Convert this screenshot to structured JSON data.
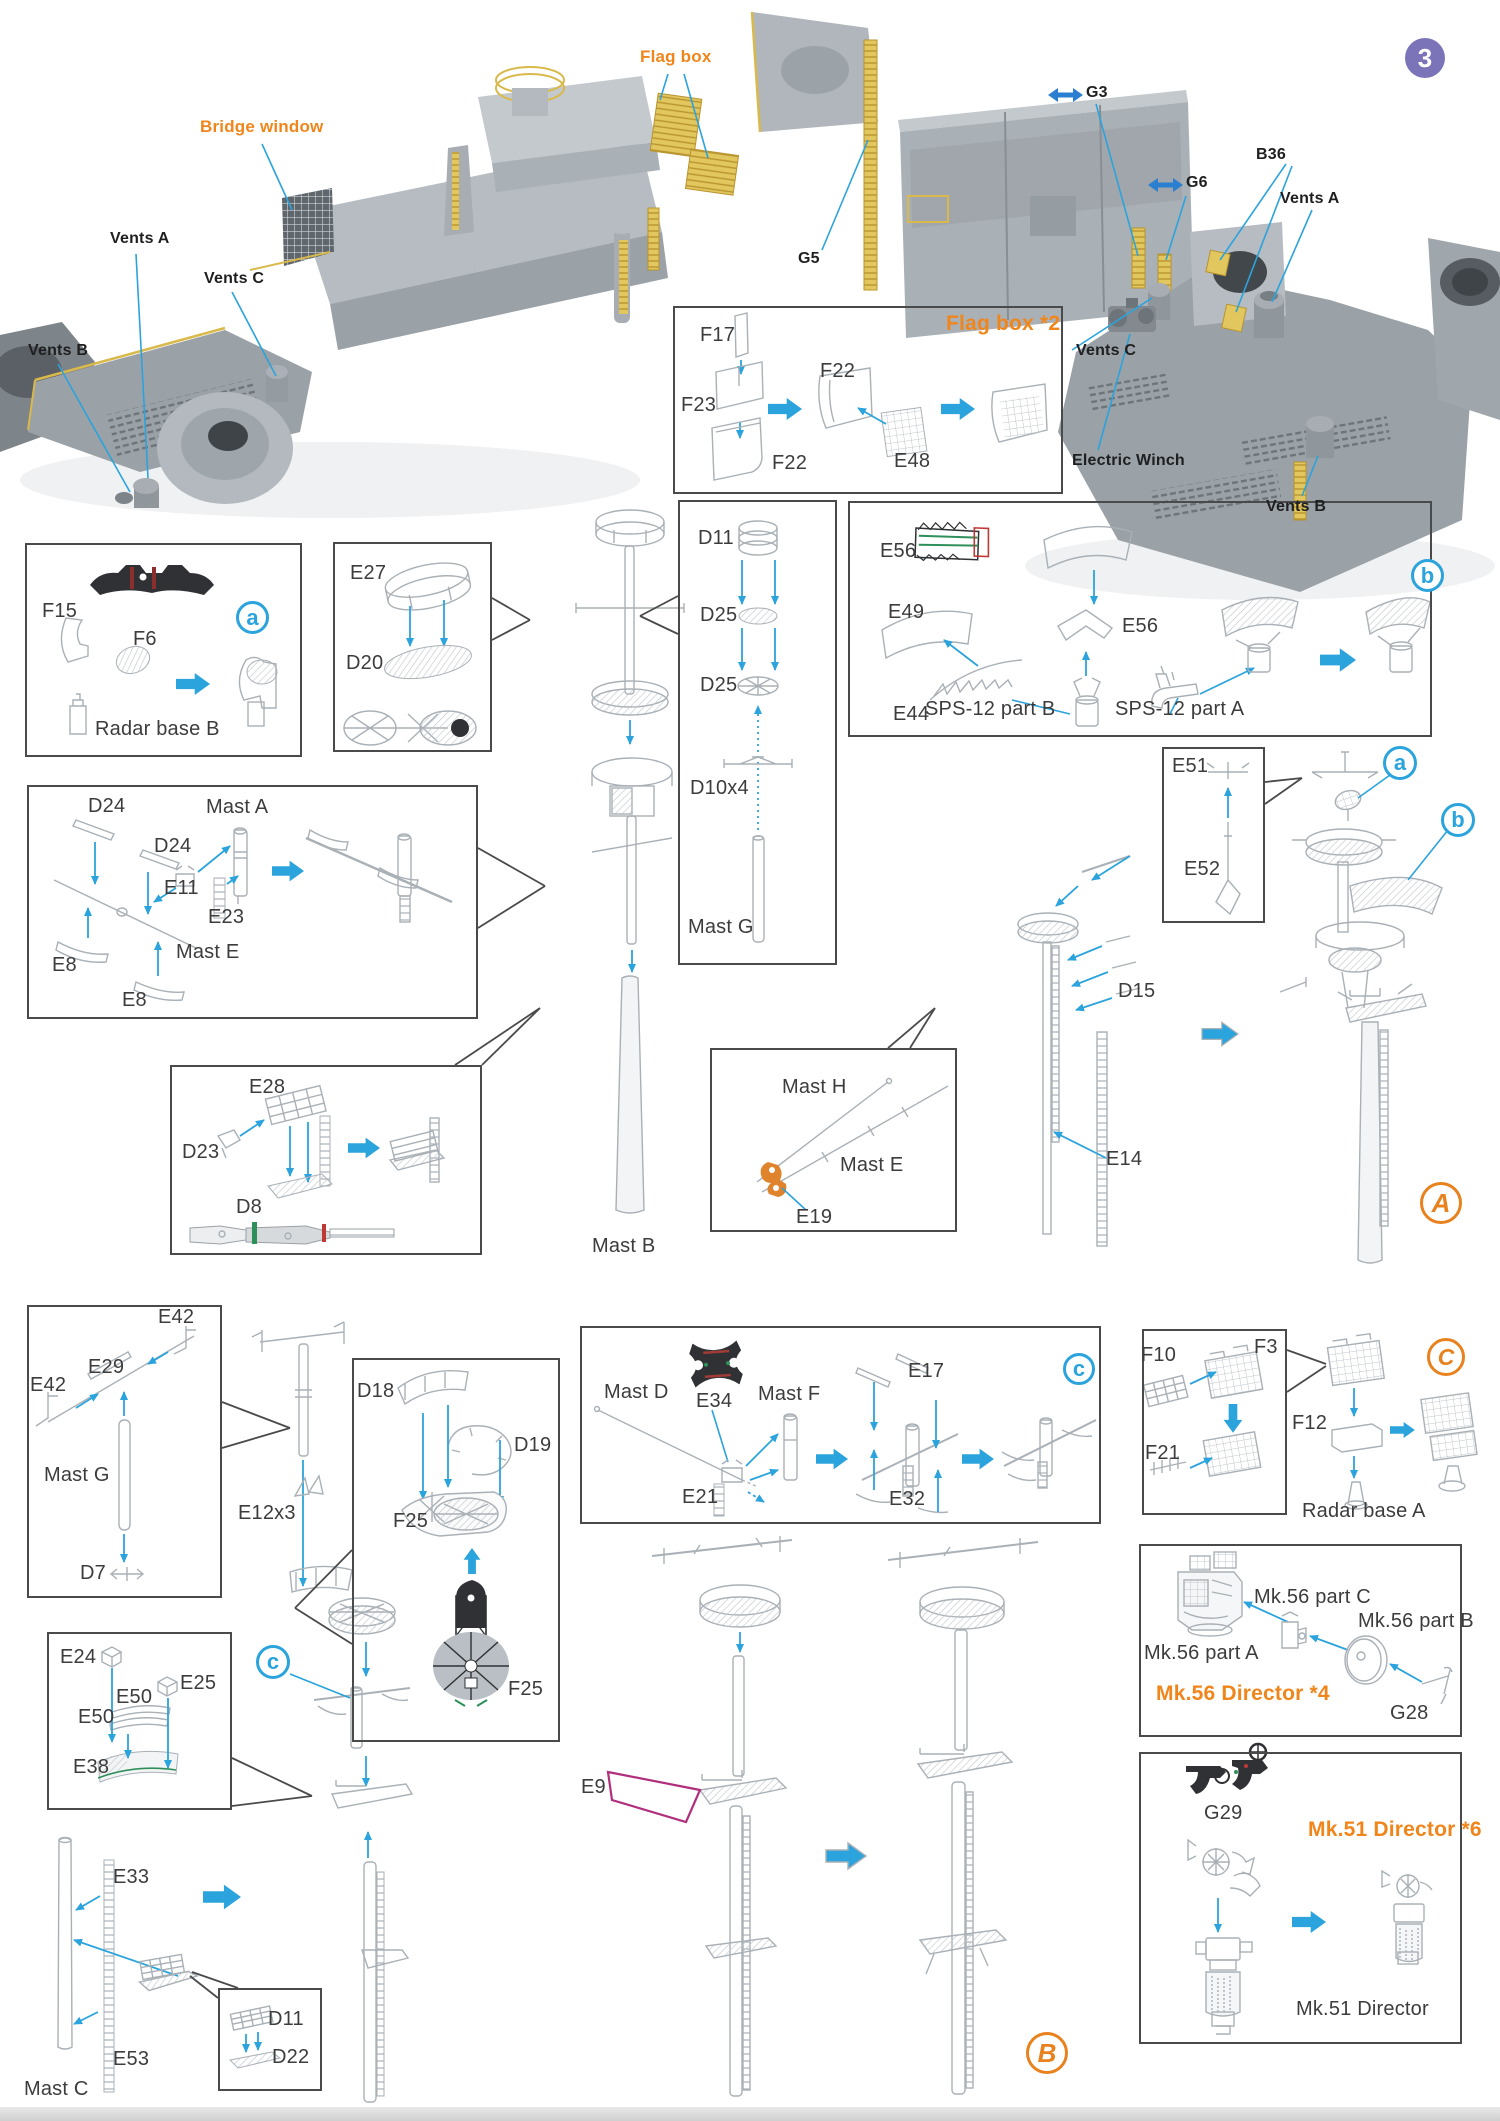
{
  "t": {
    "badge3": "3",
    "bridge_window": "Bridge window",
    "flag_box": "Flag box",
    "vents_a": "Vents A",
    "vents_b": "Vents B",
    "vents_c": "Vents C",
    "g5": "G5",
    "g3": "G3",
    "g6": "G6",
    "b36": "B36",
    "electric_winch": "Electric Winch",
    "flagbox2_title": "Flag box *2",
    "f17": "F17",
    "f23": "F23",
    "f22": "F22",
    "e48": "E48",
    "f15": "F15",
    "f6": "F6",
    "radar_base_b": "Radar base B",
    "e27": "E27",
    "d20": "D20",
    "d11": "D11",
    "d25": "D25",
    "d10x4": "D10x4",
    "mast_g": "Mast G",
    "e56": "E56",
    "e49": "E49",
    "e44": "E44",
    "sps12_b": "SPS-12 part B",
    "sps12_a": "SPS-12 part A",
    "d24": "D24",
    "mast_a": "Mast A",
    "e11": "E11",
    "e23": "E23",
    "e8": "E8",
    "mast_e": "Mast E",
    "e28": "E28",
    "d23": "D23",
    "d8": "D8",
    "mast_b": "Mast B",
    "mast_h": "Mast H",
    "e19": "E19",
    "e51": "E51",
    "e52": "E52",
    "d15": "D15",
    "e14": "E14",
    "e42": "E42",
    "e29": "E29",
    "d7": "D7",
    "e12x3": "E12x3",
    "d18": "D18",
    "d19": "D19",
    "f25": "F25",
    "mast_d": "Mast D",
    "e34": "E34",
    "mast_f": "Mast F",
    "e21": "E21",
    "e17": "E17",
    "e32": "E32",
    "f10": "F10",
    "f3": "F3",
    "f21": "F21",
    "f12": "F12",
    "radar_base_a": "Radar base A",
    "mk56_c": "Mk.56 part C",
    "mk56_b": "Mk.56 part B",
    "mk56_a": "Mk.56 part A",
    "mk56_title": "Mk.56 Director *4",
    "g28": "G28",
    "g29": "G29",
    "mk51_title": "Mk.51 Director *6",
    "mk51_caption": "Mk.51 Director",
    "e24": "E24",
    "e25": "E25",
    "e50": "E50",
    "e38": "E38",
    "d22": "D22",
    "e9": "E9",
    "e33": "E33",
    "e53": "E53",
    "mast_c": "Mast C",
    "ba": "a",
    "bb": "b",
    "bc": "c",
    "bigA": "A",
    "bigB": "B",
    "bigC": "C"
  }
}
